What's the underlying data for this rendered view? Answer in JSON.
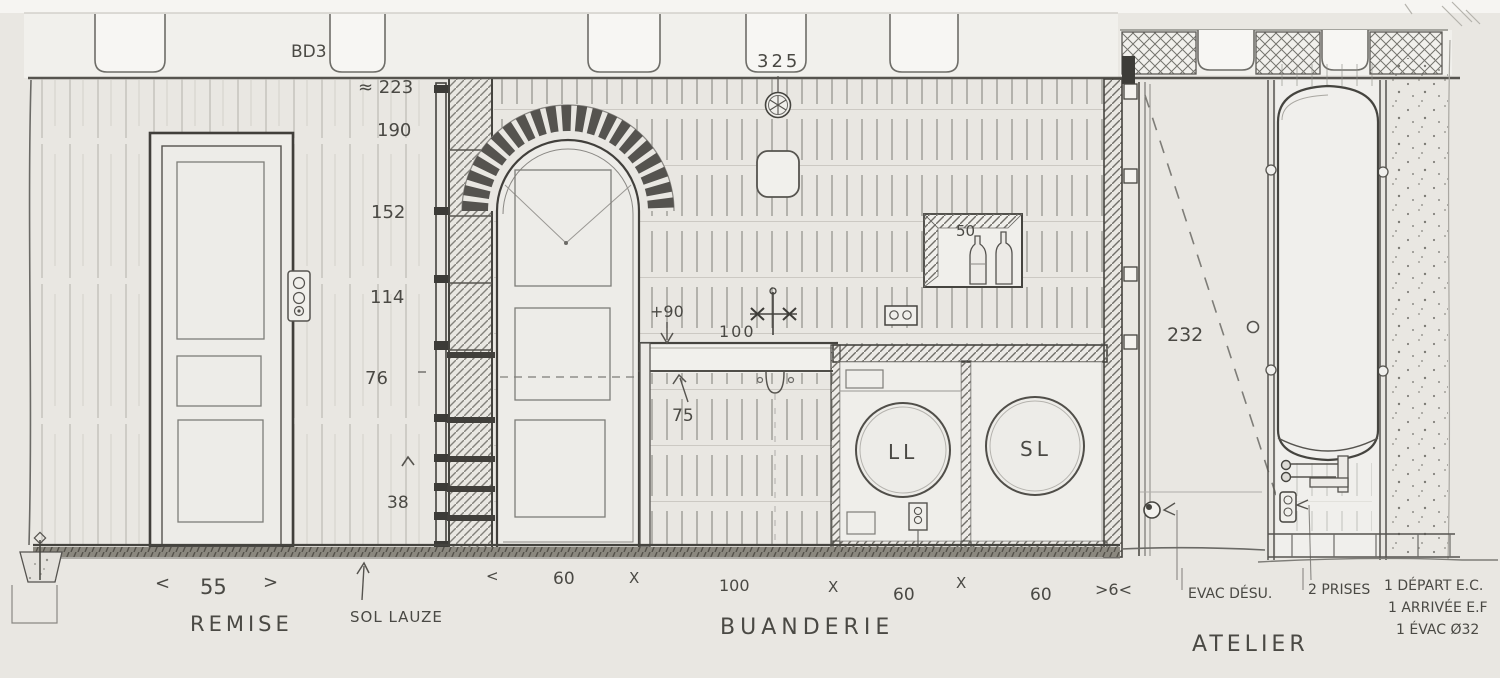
{
  "drawing": {
    "title_ref": "BD3",
    "top_dim": "325",
    "rooms": {
      "left": "REMISE",
      "center": "BUANDERIE",
      "right": "ATELIER"
    },
    "floor_label": "SOL LAUZE",
    "height_scale": [
      "≈ 223",
      "190",
      "152",
      "114",
      "76",
      "38"
    ],
    "annotations": {
      "counter_height": "+90",
      "counter_width": "100",
      "under_counter": "75",
      "niche_width": "50",
      "door_height": "232"
    },
    "machines": {
      "washer": "LL",
      "dryer": "SL"
    },
    "remise_dim": {
      "open": "<",
      "value": "55",
      "close": ">"
    },
    "bottom_dims": [
      "<",
      "60",
      "X",
      "100",
      "X",
      "60",
      "X",
      "60",
      ">6<"
    ],
    "notes": {
      "evac": "EVAC DÉSU.",
      "prises": "2 PRISES",
      "depart": "1 DÉPART E.C.",
      "arrivee": "1 ARRIVÉE E.F",
      "evac32": "1 ÉVAC Ø32"
    }
  },
  "colors": {
    "paper": "#e9e7e2",
    "paper_light": "#f2f1ed",
    "paper_white": "#f7f6f3",
    "pencil_dark": "#45443f",
    "pencil": "#6b6a66",
    "pencil_light": "#9a9894"
  }
}
